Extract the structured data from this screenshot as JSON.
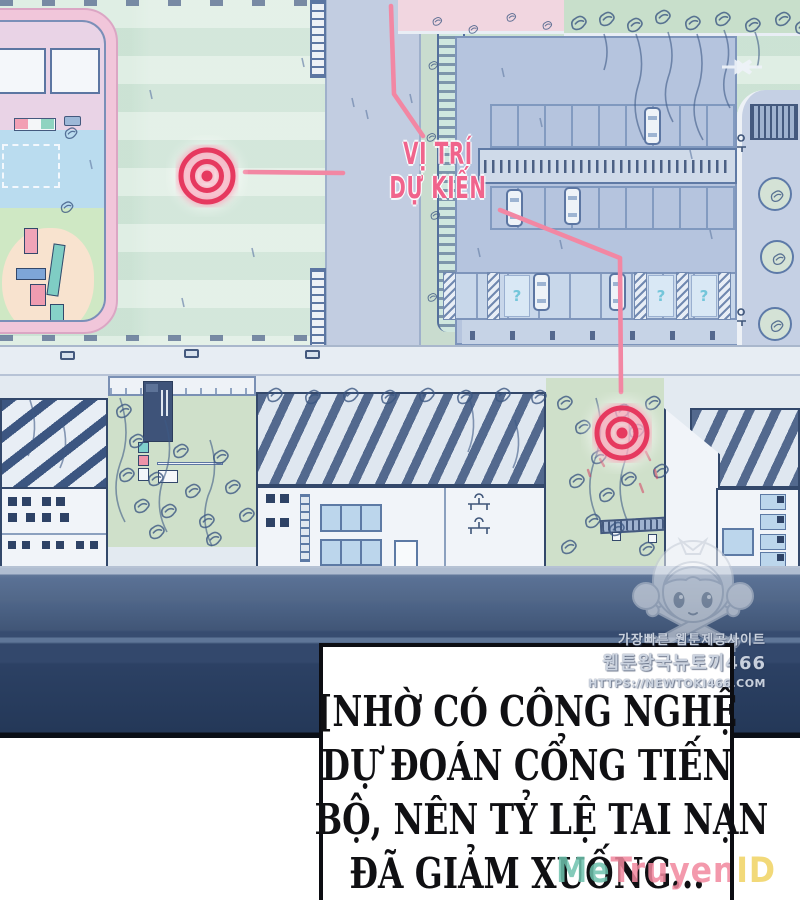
{
  "annotation": {
    "line1": "VỊ TRÍ",
    "line2": "DỰ KIẾN"
  },
  "caption": {
    "lines": [
      "[NHỜ CÓ CÔNG NGHỆ",
      "DỰ ĐOÁN CỔNG TIẾN",
      "BỘ, NÊN TỶ LỆ TAI NẠN",
      "ĐÃ GIẢM XUỐNG..."
    ]
  },
  "watermarks": {
    "korean_line1": "가장빠른 웹툰제공사이트",
    "korean_line2": "웹툰왕국뉴토끼466",
    "korean_line3": "HTTPS://NEWTOKI466.COM",
    "site_me": "Me",
    "site_truyen": "Truyen",
    "site_id": "ID"
  },
  "colors": {
    "label_pink": "#f0648c",
    "target_red": "#e6395f",
    "leader_pink": "#f287a3",
    "wall_navy": "#2c4164",
    "map_mint": "#d6e9dc",
    "lot_blue": "#b5c4de"
  }
}
